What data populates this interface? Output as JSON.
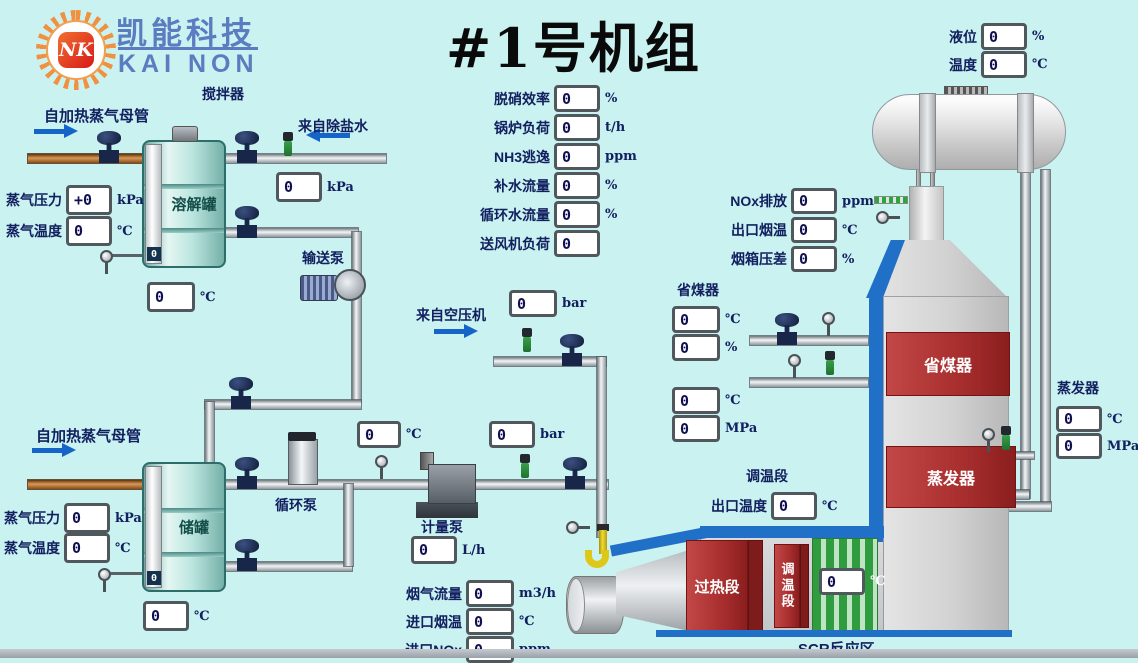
{
  "colors": {
    "background": "#c9f2f0",
    "accent_blue": "#2070c8",
    "label_navy": "#132060",
    "alarm_red": "#a82e2e",
    "scr_green": "#2f9c40",
    "logo_blue": "#5b7cc0"
  },
  "logo": {
    "company_cn": "凯能科技",
    "company_en": "KAI NON",
    "monogram": "NK"
  },
  "title": "#1号机组",
  "annotations": {
    "mixer": "搅拌器",
    "steam_header_top": "自加热蒸气母管",
    "from_desalted_water": "来自除盐水",
    "dissolve_tank": "溶解罐",
    "transfer_pump": "输送泵",
    "steam_header_bottom": "自加热蒸气母管",
    "storage_tank": "储罐",
    "circulation_pump": "循环泵",
    "from_air_compressor": "来自空压机",
    "metering_pump": "计量泵",
    "economizer_group": "省煤器",
    "tempering_section": "调温段",
    "scr_zone": "SCR反应区",
    "evaporator_group": "蒸发器",
    "tower_economizer": "省煤器",
    "tower_evaporator": "蒸发器",
    "duct_superheat": "过热段",
    "duct_tempering": "调温段"
  },
  "levels": {
    "dissolve_tank": "0",
    "storage_tank": "0"
  },
  "gauges": {
    "steam_pressure_1": {
      "label": "蒸气压力",
      "value": "+0",
      "unit": "kPa"
    },
    "steam_temp_1": {
      "label": "蒸气温度",
      "value": "0",
      "unit": "℃"
    },
    "desalt_water_pressure": {
      "value": "0",
      "unit": "kPa"
    },
    "dissolve_tank_temp": {
      "value": "0",
      "unit": "℃"
    },
    "denox_efficiency": {
      "label": "脱硝效率",
      "value": "0",
      "unit": "%"
    },
    "boiler_load": {
      "label": "锅炉负荷",
      "value": "0",
      "unit": "t/h"
    },
    "nh3_slip": {
      "label": "NH3逃逸",
      "value": "0",
      "unit": "ppm"
    },
    "makeup_water_flow": {
      "label": "补水流量",
      "value": "0",
      "unit": "%"
    },
    "circ_water_flow": {
      "label": "循环水流量",
      "value": "0",
      "unit": "%"
    },
    "fan_load": {
      "label": "送风机负荷",
      "value": "0",
      "unit": ""
    },
    "drum_level": {
      "label": "液位",
      "value": "0",
      "unit": "%"
    },
    "drum_temp": {
      "label": "温度",
      "value": "0",
      "unit": "℃"
    },
    "nox_emission": {
      "label": "NOx排放",
      "value": "0",
      "unit": "ppm"
    },
    "outlet_flue_temp": {
      "label": "出口烟温",
      "value": "0",
      "unit": "℃"
    },
    "windbox_dp": {
      "label": "烟箱压差",
      "value": "0",
      "unit": "%"
    },
    "eco_temp_a": {
      "value": "0",
      "unit": "℃"
    },
    "eco_pct": {
      "value": "0",
      "unit": "%"
    },
    "eco_temp_b": {
      "value": "0",
      "unit": "℃"
    },
    "eco_pressure": {
      "value": "0",
      "unit": "MPa"
    },
    "air_pressure": {
      "value": "0",
      "unit": "bar"
    },
    "line_temp": {
      "value": "0",
      "unit": "℃"
    },
    "line_pressure": {
      "value": "0",
      "unit": "bar"
    },
    "metering_flow": {
      "value": "0",
      "unit": "L/h"
    },
    "tempering_outlet_temp": {
      "label": "出口温度",
      "value": "0",
      "unit": "℃"
    },
    "scr_temp": {
      "value": "0",
      "unit": "℃"
    },
    "evap_temp": {
      "value": "0",
      "unit": "℃"
    },
    "evap_pressure": {
      "value": "0",
      "unit": "MPa"
    },
    "flue_gas_flow": {
      "label": "烟气流量",
      "value": "0",
      "unit": "m3/h"
    },
    "inlet_flue_temp": {
      "label": "进口烟温",
      "value": "0",
      "unit": "℃"
    },
    "inlet_nox": {
      "label": "进口NOx",
      "value": "0",
      "unit": "ppm"
    },
    "steam_pressure_2": {
      "label": "蒸气压力",
      "value": "0",
      "unit": "kPa"
    },
    "steam_temp_2": {
      "label": "蒸气温度",
      "value": "0",
      "unit": "℃"
    },
    "storage_tank_temp": {
      "value": "0",
      "unit": "℃"
    }
  }
}
